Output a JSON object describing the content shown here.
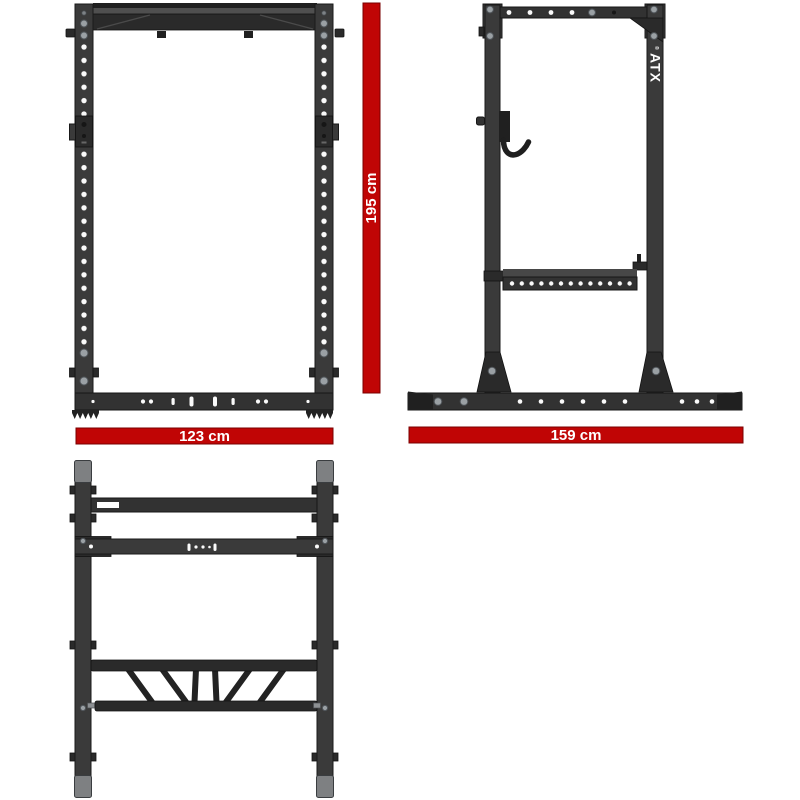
{
  "colors": {
    "red": "#c00505",
    "red-dark": "#7a0000",
    "metal": "#3a3a3a",
    "metal-mid": "#323232",
    "metal-dark": "#2a2a2a",
    "metal-light": "#4f4f4f",
    "metal-edge": "#191919",
    "cap": "#7e8082",
    "bolt": "#9aa0a4",
    "hole": "#fafafa",
    "dim-text": "#ffffff"
  },
  "dimensions": {
    "height_label": "195 cm",
    "width_label": "123 cm",
    "depth_label": "159 cm"
  },
  "brand": {
    "logo_text": "ATX",
    "registered_mark": "®"
  }
}
